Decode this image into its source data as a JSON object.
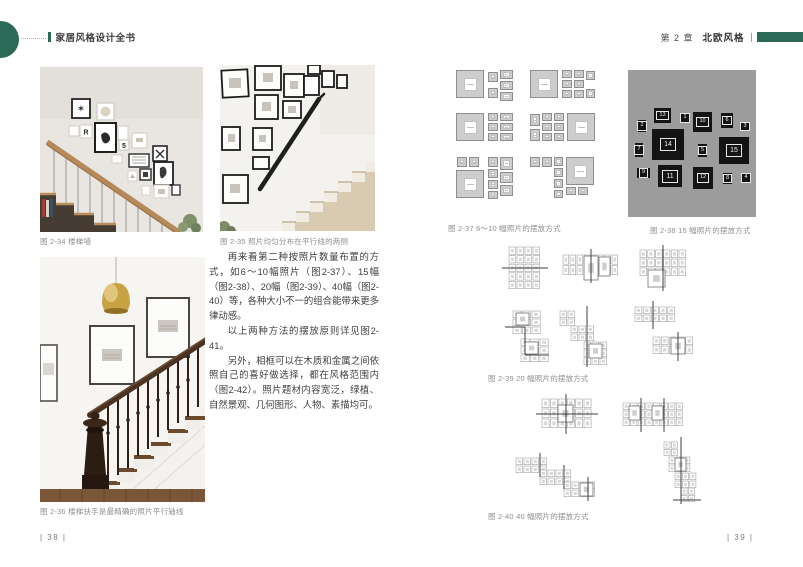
{
  "header": {
    "book_title": "家居风格设计全书",
    "chapter_label": "第 2 章",
    "chapter_title": "北欧风格"
  },
  "left_page": {
    "captions": {
      "fig_2_34": "图 2-34  楼梯墙",
      "fig_2_35": "图 2-35  照片均匀分布在平行线的两侧",
      "fig_2_36": "图 2-36  楼梯扶手是最精确的照片平行轴线"
    },
    "paragraphs": [
      "再来看第二种按照片数量布置的方式，如6～10幅照片（图2-37）、15幅（图2-38）、20幅（图2-39）、40幅（图2-40）等，各种大小不一的组合能带来更多律动感。",
      "以上两种方法的摆放原则详见图2-41。",
      "另外，相框可以在木质和金属之间依照自己的喜好做选择，都在风格范围内（图2-42）。照片题材内容宽泛，绿植、自然景观、几何图形、人物、素描均可。"
    ],
    "page_number": "| 38 |"
  },
  "right_page": {
    "captions": {
      "fig_2_37": "图 2-37  6～10 幅照片的摆放方式",
      "fig_2_38": "图 2-38  15 幅照片的摆放方式",
      "fig_2_39": "图 2-39  20 幅照片的摆放方式",
      "fig_2_40": "图 2-40  40 幅照片的摆放方式"
    },
    "fig_2_38_frame_numbers": [
      "1",
      "2",
      "3",
      "4",
      "5",
      "6",
      "7",
      "8",
      "9",
      "10",
      "11",
      "12",
      "13",
      "14",
      "15"
    ],
    "page_number": "| 39 |"
  },
  "colors": {
    "accent_green": "#2b6a56",
    "fig38_panel_bg": "#9c9c9c",
    "frame_black": "#141414",
    "caption_gray": "#8f8f8f"
  },
  "illustrations": {
    "photo1_glyphs": [
      "R",
      "5"
    ],
    "fig37_frames": [
      [
        8,
        4,
        28,
        28
      ],
      [
        40,
        6,
        10,
        10
      ],
      [
        40,
        22,
        10,
        10
      ],
      [
        52,
        4,
        13,
        9
      ],
      [
        52,
        15,
        13,
        9
      ],
      [
        52,
        26,
        13,
        9
      ],
      [
        82,
        4,
        28,
        28
      ],
      [
        114,
        4,
        10,
        8
      ],
      [
        114,
        14,
        10,
        8
      ],
      [
        114,
        24,
        10,
        8
      ],
      [
        126,
        4,
        10,
        8
      ],
      [
        126,
        14,
        10,
        8
      ],
      [
        126,
        24,
        10,
        8
      ],
      [
        138,
        5,
        9,
        9
      ],
      [
        138,
        23,
        9,
        9
      ],
      [
        8,
        47,
        28,
        28
      ],
      [
        40,
        47,
        10,
        8
      ],
      [
        40,
        57,
        10,
        8
      ],
      [
        40,
        67,
        10,
        8
      ],
      [
        52,
        47,
        13,
        8
      ],
      [
        52,
        57,
        13,
        8
      ],
      [
        52,
        67,
        13,
        8
      ],
      [
        82,
        48,
        10,
        12
      ],
      [
        82,
        63,
        10,
        12
      ],
      [
        94,
        47,
        10,
        8
      ],
      [
        94,
        57,
        10,
        8
      ],
      [
        94,
        67,
        10,
        8
      ],
      [
        106,
        47,
        10,
        8
      ],
      [
        106,
        57,
        10,
        8
      ],
      [
        106,
        67,
        10,
        8
      ],
      [
        119,
        47,
        28,
        28
      ],
      [
        9,
        91,
        10,
        10
      ],
      [
        21,
        91,
        10,
        10
      ],
      [
        40,
        91,
        10,
        10
      ],
      [
        52,
        91,
        13,
        13
      ],
      [
        8,
        104,
        28,
        28
      ],
      [
        40,
        103,
        10,
        9
      ],
      [
        40,
        114,
        10,
        9
      ],
      [
        52,
        106,
        13,
        11
      ],
      [
        52,
        119,
        13,
        11
      ],
      [
        40,
        125,
        10,
        8
      ],
      [
        82,
        91,
        10,
        10
      ],
      [
        94,
        91,
        10,
        10
      ],
      [
        106,
        91,
        9,
        9
      ],
      [
        106,
        102,
        9,
        9
      ],
      [
        118,
        91,
        28,
        28
      ],
      [
        106,
        113,
        9,
        9
      ],
      [
        106,
        124,
        9,
        8
      ],
      [
        118,
        121,
        10,
        8
      ],
      [
        130,
        121,
        10,
        8
      ]
    ],
    "fig38_frames": [
      {
        "n": "2",
        "x": 10,
        "y": 50,
        "w": 8,
        "h": 12
      },
      {
        "n": "13",
        "x": 26,
        "y": 38,
        "w": 17,
        "h": 15
      },
      {
        "n": "1",
        "x": 53,
        "y": 43,
        "w": 8,
        "h": 10
      },
      {
        "n": "10",
        "x": 65,
        "y": 42,
        "w": 19,
        "h": 20
      },
      {
        "n": "6",
        "x": 93,
        "y": 43,
        "w": 12,
        "h": 15
      },
      {
        "n": "3",
        "x": 113,
        "y": 52,
        "w": 8,
        "h": 9
      },
      {
        "n": "7",
        "x": 7,
        "y": 73,
        "w": 8,
        "h": 14
      },
      {
        "n": "14",
        "x": 24,
        "y": 59,
        "w": 32,
        "h": 31
      },
      {
        "n": "5",
        "x": 70,
        "y": 74,
        "w": 9,
        "h": 13
      },
      {
        "n": "15",
        "x": 91,
        "y": 67,
        "w": 30,
        "h": 27
      },
      {
        "n": "9",
        "x": 9,
        "y": 98,
        "w": 13,
        "h": 10
      },
      {
        "n": "11",
        "x": 30,
        "y": 95,
        "w": 24,
        "h": 22
      },
      {
        "n": "12",
        "x": 65,
        "y": 97,
        "w": 20,
        "h": 22
      },
      {
        "n": "8",
        "x": 95,
        "y": 103,
        "w": 9,
        "h": 11
      },
      {
        "n": "4",
        "x": 114,
        "y": 103,
        "w": 8,
        "h": 10
      }
    ]
  }
}
